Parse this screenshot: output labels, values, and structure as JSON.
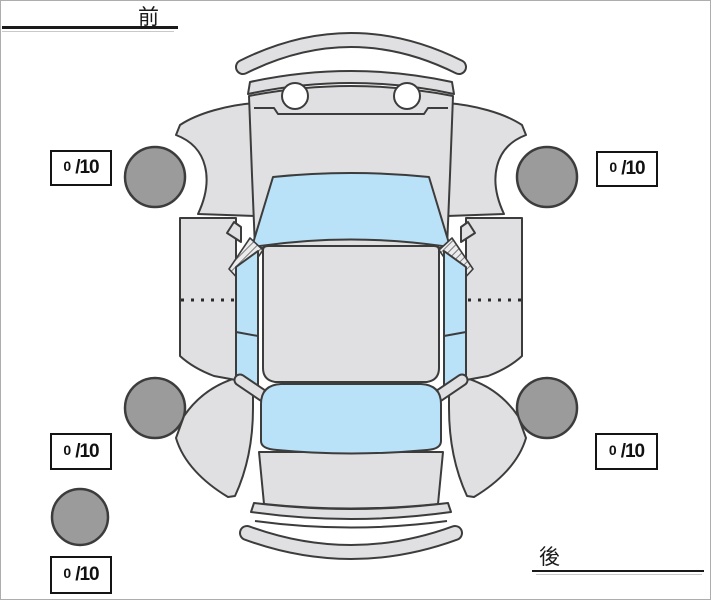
{
  "diagram": {
    "front_label": "前",
    "rear_label": "後"
  },
  "ratings": {
    "front_left": {
      "value": "0",
      "scale": "/10"
    },
    "front_right": {
      "value": "0",
      "scale": "/10"
    },
    "rear_left": {
      "value": "0",
      "scale": "/10"
    },
    "rear_right": {
      "value": "0",
      "scale": "/10"
    },
    "spare": {
      "value": "0",
      "scale": "/10"
    }
  },
  "colors": {
    "body_fill": "#e0e0e2",
    "glass_fill": "#b9e1f8",
    "tire_fill": "#9b9b9b",
    "outline": "#3c3c3c",
    "text_color": "#1a1a1a"
  }
}
